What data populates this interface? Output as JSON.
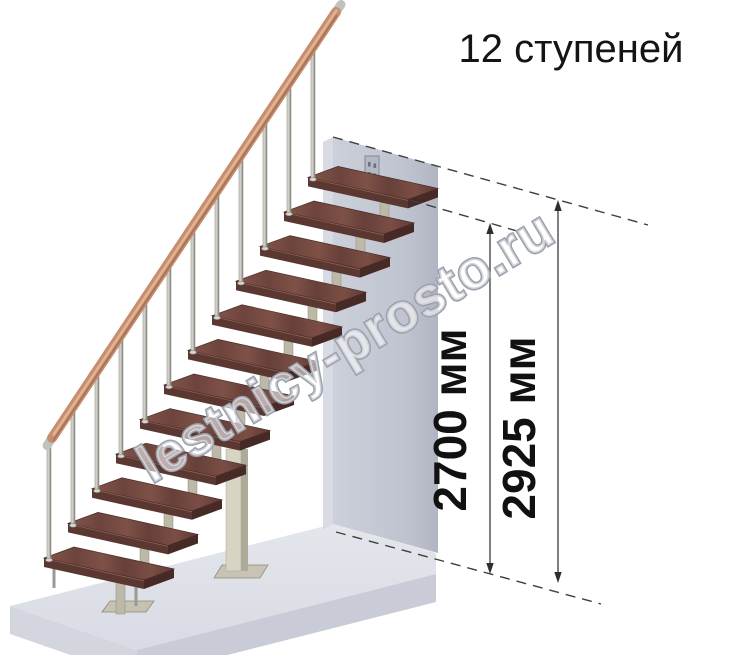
{
  "illustration": {
    "title": "12 ступеней",
    "watermark": "lestnicy-prosto.ru"
  },
  "dimensions": {
    "inner_height": "2700 мм",
    "overall_height": "2925 мм"
  },
  "stairs": {
    "steps_count": 12
  },
  "colors": {
    "background": "#ffffff",
    "tread_wood": "#7a4e46",
    "tread_wood_dark": "#5a3831",
    "handrail_copper": "#c68e70",
    "metal_frame_beige": "#bdb9a8",
    "branch_cream": "#eee9da",
    "baluster_silver": "#cfcfc7",
    "wall_gray": "#c3c6d2",
    "floor_gray": "#dfe1e9",
    "dimension_line": "#3f3f3f",
    "text_black": "#141414",
    "watermark_outline": "#9ba1ac"
  }
}
